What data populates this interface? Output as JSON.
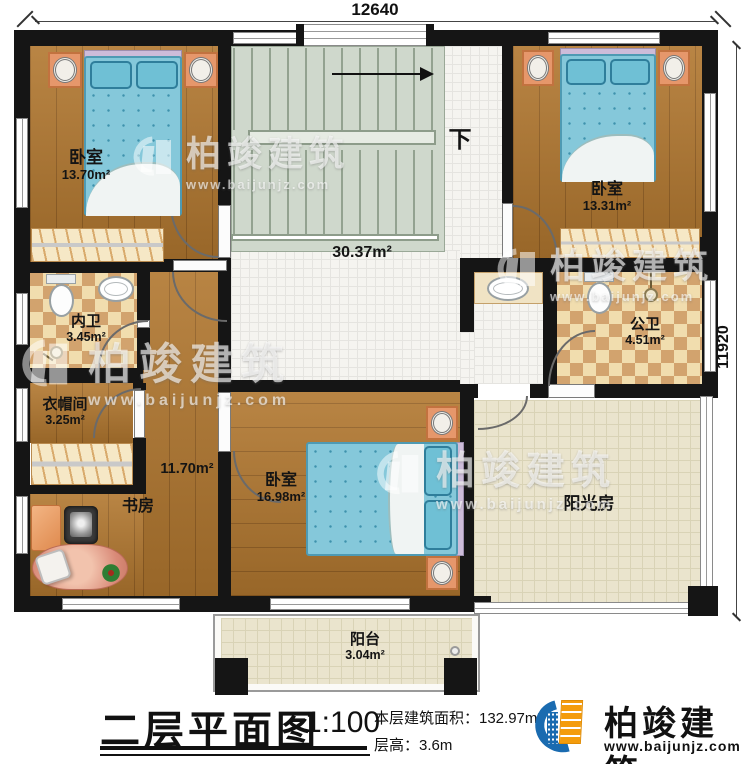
{
  "plan": {
    "dimension_top": "12640",
    "dimension_right": "11920",
    "stairs_down": "下"
  },
  "rooms": {
    "bedroom_tl": {
      "name": "卧室",
      "area": "13.70m²"
    },
    "bedroom_tr": {
      "name": "卧室",
      "area": "13.31m²"
    },
    "hall": {
      "area": "30.37m²"
    },
    "inner_bath": {
      "name": "内卫",
      "area": "3.45m²"
    },
    "cloakroom": {
      "name": "衣帽间",
      "area": "3.25m²"
    },
    "corridor": {
      "area": "11.70m²"
    },
    "study": {
      "name": "书房"
    },
    "bedroom_bottom": {
      "name": "卧室",
      "area": "16.98m²"
    },
    "public_bath": {
      "name": "公卫",
      "area": "4.51m²"
    },
    "sunroom": {
      "name": "阳光房"
    },
    "balcony": {
      "name": "阳台",
      "area": "3.04m²"
    }
  },
  "title_block": {
    "title": "二层平面图",
    "scale": "1:100",
    "floor_area": "本层建筑面积：132.97m²",
    "floor_height": "层高：3.6m"
  },
  "brand": {
    "name": "柏竣建筑",
    "website": "www.baijunjz.com"
  },
  "watermark": {
    "name": "柏竣建筑",
    "website": "www.baijunjz.com"
  }
}
